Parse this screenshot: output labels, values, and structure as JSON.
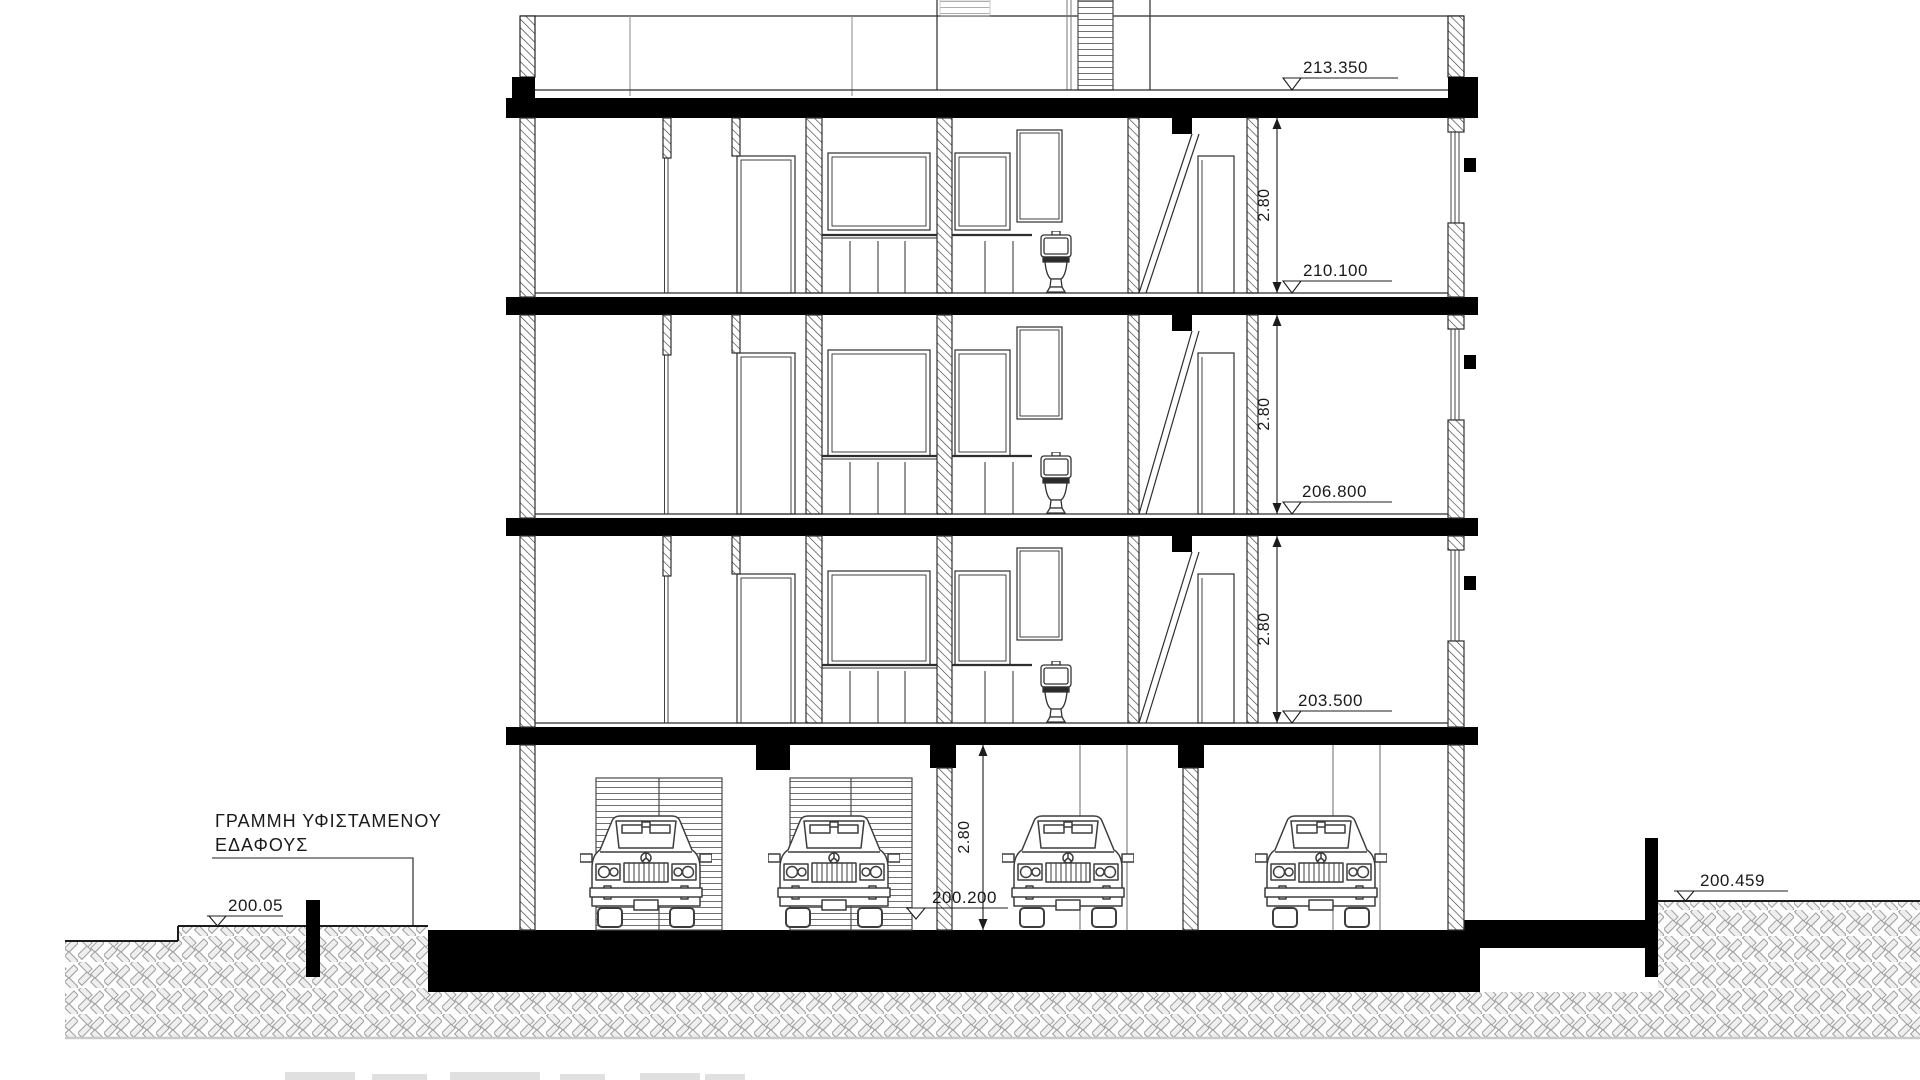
{
  "note_ground": {
    "line1": "ΓΡΑΜΜΗ ΥΦΙΣΤΑΜΕΝΟΥ",
    "line2": "ΕΔΑΦΟΥΣ"
  },
  "levels": {
    "roof": "213.350",
    "floor3": "210.100",
    "floor2": "206.800",
    "floor1": "203.500",
    "parking": "200.200",
    "ground_left": "200.05",
    "ground_right": "200.459"
  },
  "heights": {
    "floor3": "2.80",
    "floor2": "2.80",
    "floor1": "2.80",
    "parking": "2.80"
  },
  "colors": {
    "ink": "#000000",
    "line": "#2e2e2e",
    "hatch": "#9a9a9a",
    "paper": "#ffffff"
  }
}
